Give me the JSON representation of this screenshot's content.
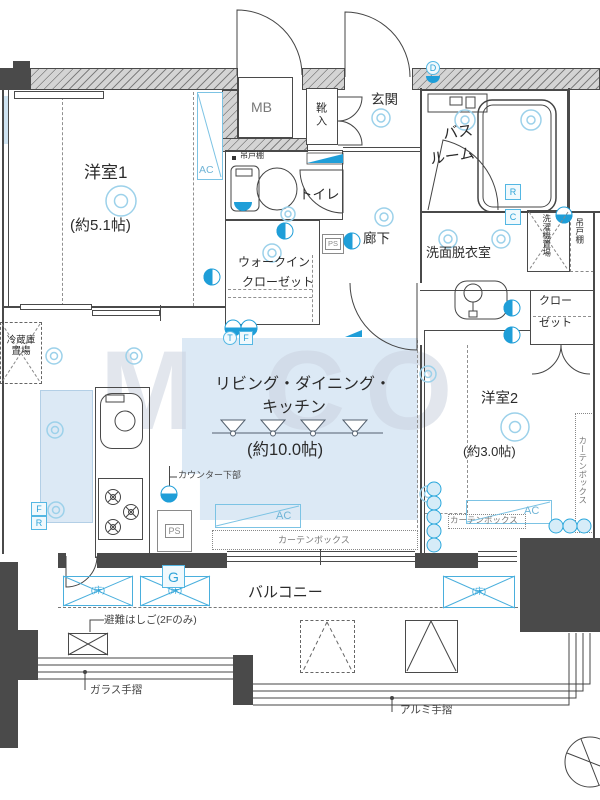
{
  "watermark": "M CO",
  "rooms": {
    "bedroom1": {
      "name": "洋室1",
      "size": "(約5.1帖)"
    },
    "bedroom2": {
      "name": "洋室2",
      "size": "(約3.0帖)"
    },
    "ldk": {
      "line1": "リビング・ダイニング・",
      "line2": "キッチン",
      "size": "(約10.0帖)"
    },
    "bath": {
      "line1": "バス",
      "line2": "ルーム"
    },
    "washroom": {
      "name": "洗面脱衣室"
    },
    "entrance": {
      "name": "玄関"
    },
    "hallway": {
      "name": "廊下"
    },
    "toilet": {
      "name": "トイレ"
    },
    "wic": {
      "line1": "ウォークイン",
      "line2": "クローゼット"
    },
    "closet": {
      "line1": "クロー",
      "line2": "ゼット"
    },
    "balcony": {
      "name": "バルコニー"
    }
  },
  "fixtures": {
    "mb": "MB",
    "shoe_box": "靴入",
    "ps": "PS",
    "hanging_cupboard": "吊戸棚",
    "washer_space": "洗濯機置場",
    "fridge_space": "冷蔵庫置場",
    "counter_lower": "カウンター下部",
    "curtain_box": "カーテンボックス",
    "ac": "AC",
    "floor_hatch": "(床)",
    "escape_ladder": "避難はしご(2Fのみ)",
    "glass_rail": "ガラス手摺",
    "alumi_rail": "アルミ手摺"
  },
  "badges": {
    "d": "D",
    "g": "G",
    "f": "F",
    "r": "R",
    "c": "C",
    "t": "T"
  },
  "colors": {
    "accent_blue": "#1f9ed8",
    "light_blue_fill": "#dce9f5",
    "wall_dark": "#4a4a4a",
    "hatch_gray": "#b5b5b5"
  }
}
